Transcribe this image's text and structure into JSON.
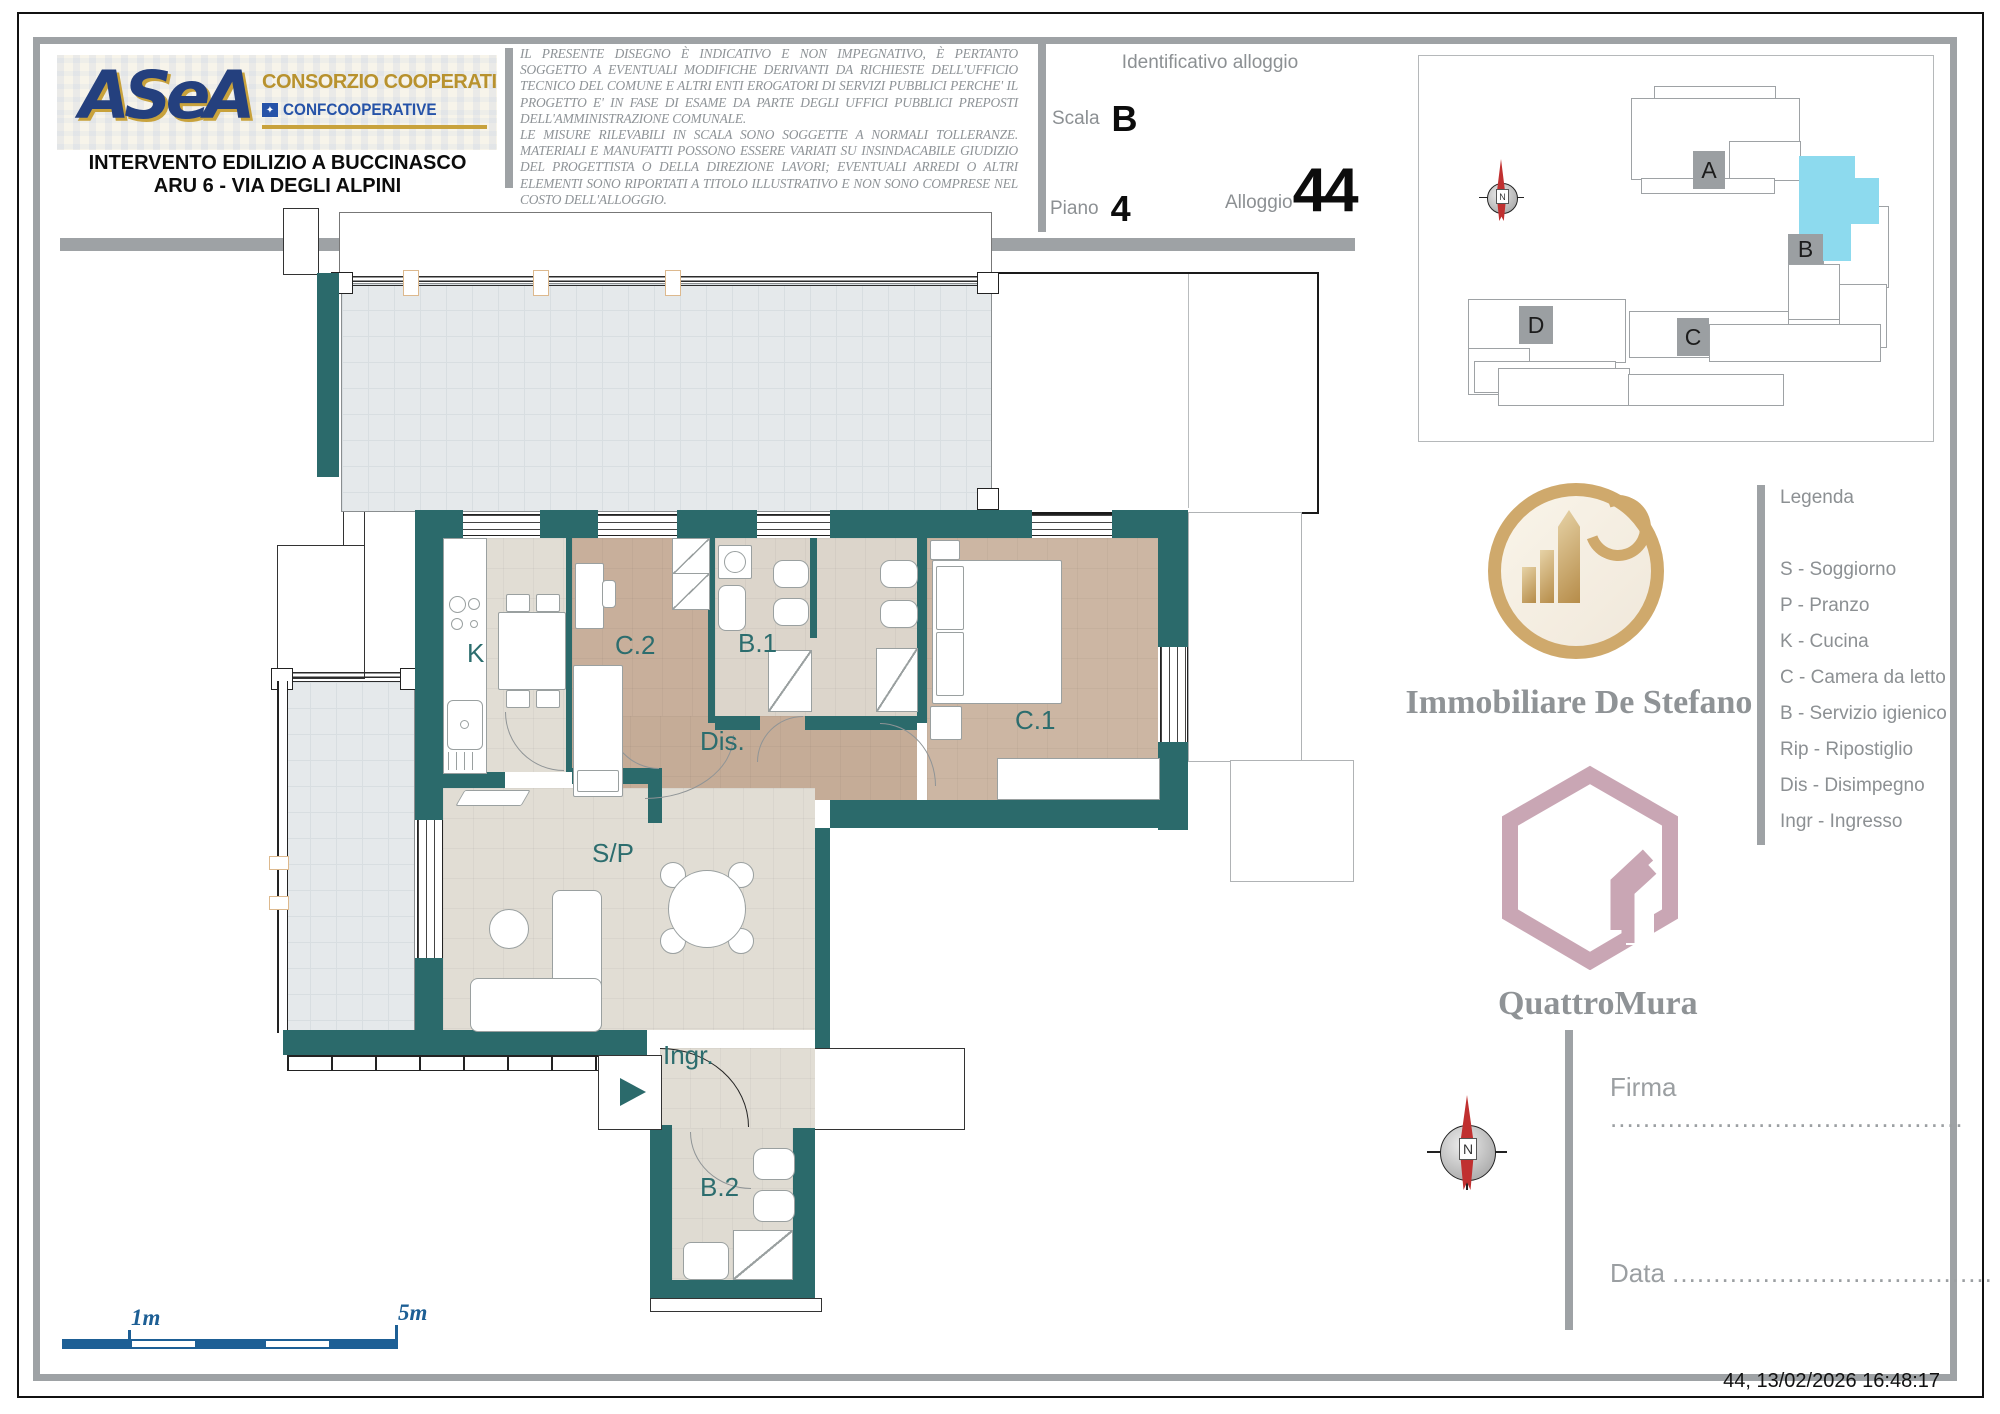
{
  "header": {
    "logo": {
      "brand": "ASeA",
      "org_line": "CONSORZIO COOPERATIVO",
      "org_suffix": "SOC. COOP.",
      "assoc_line": "CONFCOOPERATIVE",
      "assoc_icon_glyph": "✦"
    },
    "title_line1": "INTERVENTO EDILIZIO A BUCCINASCO",
    "title_line2": "ARU 6 - VIA DEGLI ALPINI",
    "disclaimer_p1": "IL PRESENTE DISEGNO È INDICATIVO E NON IMPEGNATIVO, È PERTANTO SOGGETTO A EVENTUALI MODIFICHE DERIVANTI DA RICHIESTE DELL'UFFICIO TECNICO DEL COMUNE E ALTRI ENTI EROGATORI DI SERVIZI PUBBLICI PERCHE' IL PROGETTO E' IN FASE DI ESAME DA PARTE DEGLI UFFICI PUBBLICI PREPOSTI DELL'AMMINISTRAZIONE COMUNALE.",
    "disclaimer_p2": "LE MISURE RILEVABILI IN SCALA SONO SOGGETTE A NORMALI TOLLERANZE. MATERIALI E MANUFATTI POSSONO ESSERE VARIATI SU INSINDACABILE GIUDIZIO DEL PROGETTISTA O DELLA DIREZIONE LAVORI; EVENTUALI ARREDI O ALTRI ELEMENTI SONO RIPORTATI A TITOLO ILLUSTRATIVO E NON SONO COMPRESE NEL COSTO DELL'ALLOGGIO."
  },
  "identification": {
    "heading": "Identificativo alloggio",
    "scala_label": "Scala",
    "scala_value": "B",
    "piano_label": "Piano",
    "piano_value": "4",
    "alloggio_label": "Alloggio",
    "alloggio_value": "44"
  },
  "keyplan": {
    "blocks": [
      "A",
      "B",
      "C",
      "D"
    ],
    "highlight_color": "#8ddaee",
    "north_letter": "N"
  },
  "plan": {
    "rooms": [
      "K",
      "C.2",
      "B.1",
      "C.1",
      "Dis.",
      "S/P",
      "Ingr.",
      "B.2"
    ],
    "wall_color": "#2b6a6b"
  },
  "legend": {
    "title": "Legenda",
    "items": [
      "S - Soggiorno",
      "P - Pranzo",
      "K - Cucina",
      "C - Camera da letto",
      "B - Servizio igienico",
      "Rip - Ripostiglio",
      "Dis - Disimpegno",
      "Ingr - Ingresso"
    ]
  },
  "branding": {
    "agency_name": "Immobiliare De Stefano",
    "builder_name": "QuattroMura"
  },
  "signature": {
    "firma_label": "Firma",
    "firma_dots": "...........................................",
    "data_label": "Data",
    "data_dots": "......................................."
  },
  "scalebar": {
    "label_1m": "1m",
    "label_5m": "5m",
    "color": "#1d5f95"
  },
  "footer": {
    "stamp": "44, 13/02/2026 16:48:17"
  }
}
